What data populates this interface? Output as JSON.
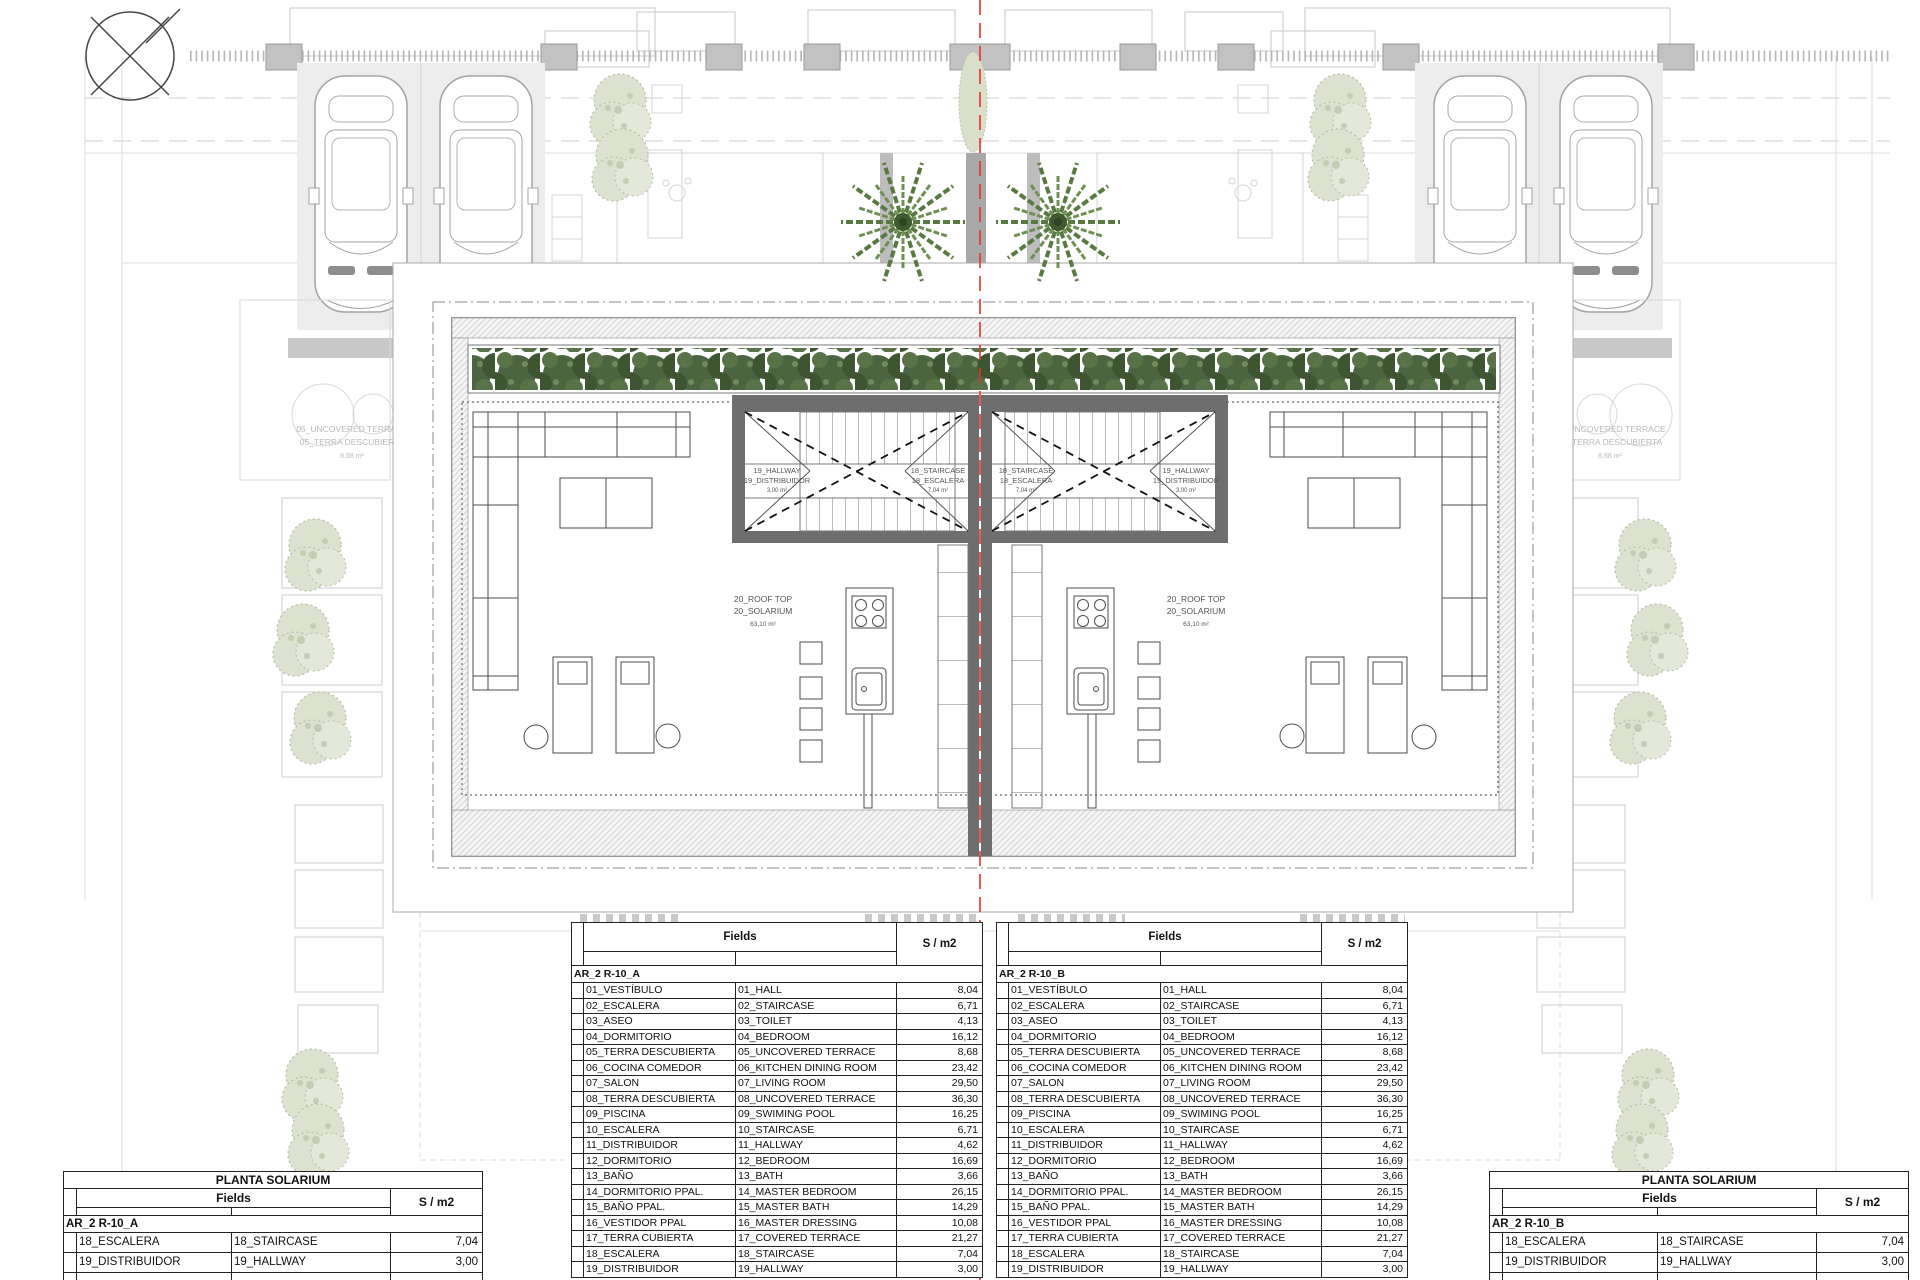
{
  "plan": {
    "labels": {
      "hallway": [
        "19_HALLWAY",
        "19_DISTRIBUIDOR",
        "3,00 m²"
      ],
      "staircase": [
        "18_STAIRCASE",
        "18_ESCALERA",
        "7,04 m²"
      ],
      "rooftop": [
        "20_ROOF TOP",
        "20_SOLARIUM",
        "63,10 m²"
      ],
      "uncovered_terrace": [
        "05_UNCOVERED TERRACE",
        "05_TERRA DESCUBIERTA",
        "8,68 m²"
      ]
    }
  },
  "tables": {
    "fields_header": "Fields",
    "area_header": "S / m2",
    "solarium_title": "PLANTA SOLARIUM",
    "group_a": "AR_2 R-10_A",
    "group_b": "AR_2 R-10_B",
    "rooms": [
      [
        "01_VESTÍBULO",
        "01_HALL",
        "8,04"
      ],
      [
        "02_ESCALERA",
        "02_STAIRCASE",
        "6,71"
      ],
      [
        "03_ASEO",
        "03_TOILET",
        "4,13"
      ],
      [
        "04_DORMITORIO",
        "04_BEDROOM",
        "16,12"
      ],
      [
        "05_TERRA DESCUBIERTA",
        "05_UNCOVERED TERRACE",
        "8,68"
      ],
      [
        "06_COCINA COMEDOR",
        "06_KITCHEN DINING ROOM",
        "23,42"
      ],
      [
        "07_SALON",
        "07_LIVING ROOM",
        "29,50"
      ],
      [
        "08_TERRA DESCUBIERTA",
        "08_UNCOVERED TERRACE",
        "36,30"
      ],
      [
        "09_PISCINA",
        "09_SWIMING POOL",
        "16,25"
      ],
      [
        "10_ESCALERA",
        "10_STAIRCASE",
        "6,71"
      ],
      [
        "11_DISTRIBUIDOR",
        "11_HALLWAY",
        "4,62"
      ],
      [
        "12_DORMITORIO",
        "12_BEDROOM",
        "16,69"
      ],
      [
        "13_BAÑO",
        "13_BATH",
        "3,66"
      ],
      [
        "14_DORMITORIO PPAL.",
        "14_MASTER BEDROOM",
        "26,15"
      ],
      [
        "15_BAÑO PPAL.",
        "15_MASTER BATH",
        "14,29"
      ],
      [
        "16_VESTIDOR PPAL",
        "16_MASTER DRESSING",
        "10,08"
      ],
      [
        "17_TERRA CUBIERTA",
        "17_COVERED TERRACE",
        "21,27"
      ],
      [
        "18_ESCALERA",
        "18_STAIRCASE",
        "7,04"
      ],
      [
        "19_DISTRIBUIDOR",
        "19_HALLWAY",
        "3,00"
      ]
    ],
    "solarium_rooms": [
      [
        "18_ESCALERA",
        "18_STAIRCASE",
        "7,04"
      ],
      [
        "19_DISTRIBUIDOR",
        "19_HALLWAY",
        "3,00"
      ]
    ]
  },
  "colors": {
    "section_line": "#e5332a",
    "wall": "#6e6e6e",
    "hedge": "#47623d",
    "pale_tree": "#dde2d0"
  }
}
